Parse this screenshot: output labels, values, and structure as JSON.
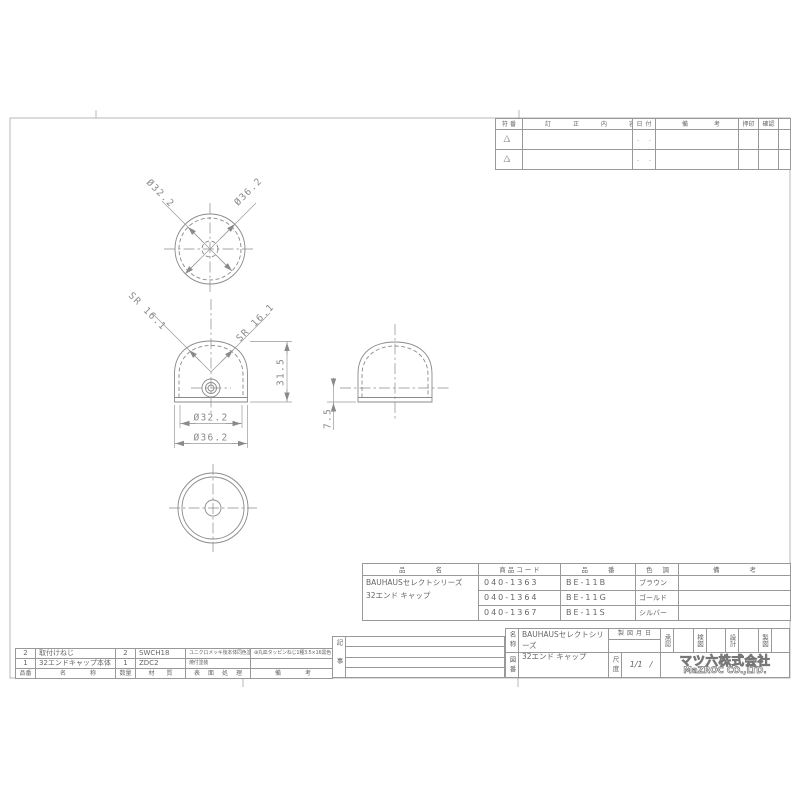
{
  "colors": {
    "line": "#8a8a8a",
    "text": "#666666"
  },
  "dims": {
    "top_d_inner": "Ø32.2",
    "top_d_outer": "Ø36.2",
    "sr_left": "SR 16.1",
    "sr_right": "SR 16.1",
    "height": "31.5",
    "front_d_inner": "Ø32.2",
    "front_d_outer": "Ø36.2",
    "side_skirt": "7.5"
  },
  "revision_table": {
    "headers": {
      "mark": "符番",
      "content": "訂正内容",
      "date": "日付",
      "remark": "備考",
      "stamp": "押印",
      "confirm": "確認"
    },
    "rows": [
      {
        "mark_icon": "△",
        "mark": "1",
        "content": "",
        "date": ". .",
        "remark": "",
        "stamp": "",
        "confirm": ""
      },
      {
        "mark_icon": "△",
        "mark": "2",
        "content": "",
        "date": ". .",
        "remark": "",
        "stamp": "",
        "confirm": ""
      }
    ]
  },
  "product_table": {
    "headers": {
      "name": "品名",
      "code": "商品コード",
      "part_no": "品番",
      "color": "色調",
      "remark": "備考"
    },
    "name_line1": "BAUHAUSセレクトシリーズ",
    "name_line2": "32エンド キャップ",
    "rows": [
      {
        "code": "040-1363",
        "part_no": "BE-11B",
        "color": "ブラウン",
        "remark": ""
      },
      {
        "code": "040-1364",
        "part_no": "BE-11G",
        "color": "ゴールド",
        "remark": ""
      },
      {
        "code": "040-1367",
        "part_no": "BE-11S",
        "color": "シルバー",
        "remark": ""
      }
    ]
  },
  "parts_table": {
    "headers": {
      "no": "品番",
      "name": "名称",
      "qty": "数量",
      "material": "材質",
      "finish": "表面処理",
      "remark": "備考"
    },
    "rows": [
      {
        "no": "2",
        "name": "取付けねじ",
        "qty": "2",
        "material": "SWCH18",
        "finish": "ユニクロメッキ後本体同色塗装",
        "remark": "⊕丸皿タッピンねじ1種3.5×16黒色"
      },
      {
        "no": "1",
        "name": "32エンドキャップ本体",
        "qty": "1",
        "material": "ZDC2",
        "finish": "焼付塗装",
        "remark": ""
      }
    ]
  },
  "notes_label": "記事",
  "title_block": {
    "name_label": "名称",
    "name_line1": "BAUHAUSセレクトシリーズ",
    "name_line2": "32エンド キャップ",
    "date_label": "製図月日",
    "date_value": "",
    "sign_labels": [
      "承認",
      "検図",
      "設計",
      "製図"
    ],
    "drawing_no_label": "図番",
    "drawing_no_value": "",
    "scale_label": "尺度",
    "scale_value": "1/1",
    "scale_extra": "/",
    "company_jp": "マツ六株式会社",
    "company_en": "MaZROC CO.,LTD."
  }
}
